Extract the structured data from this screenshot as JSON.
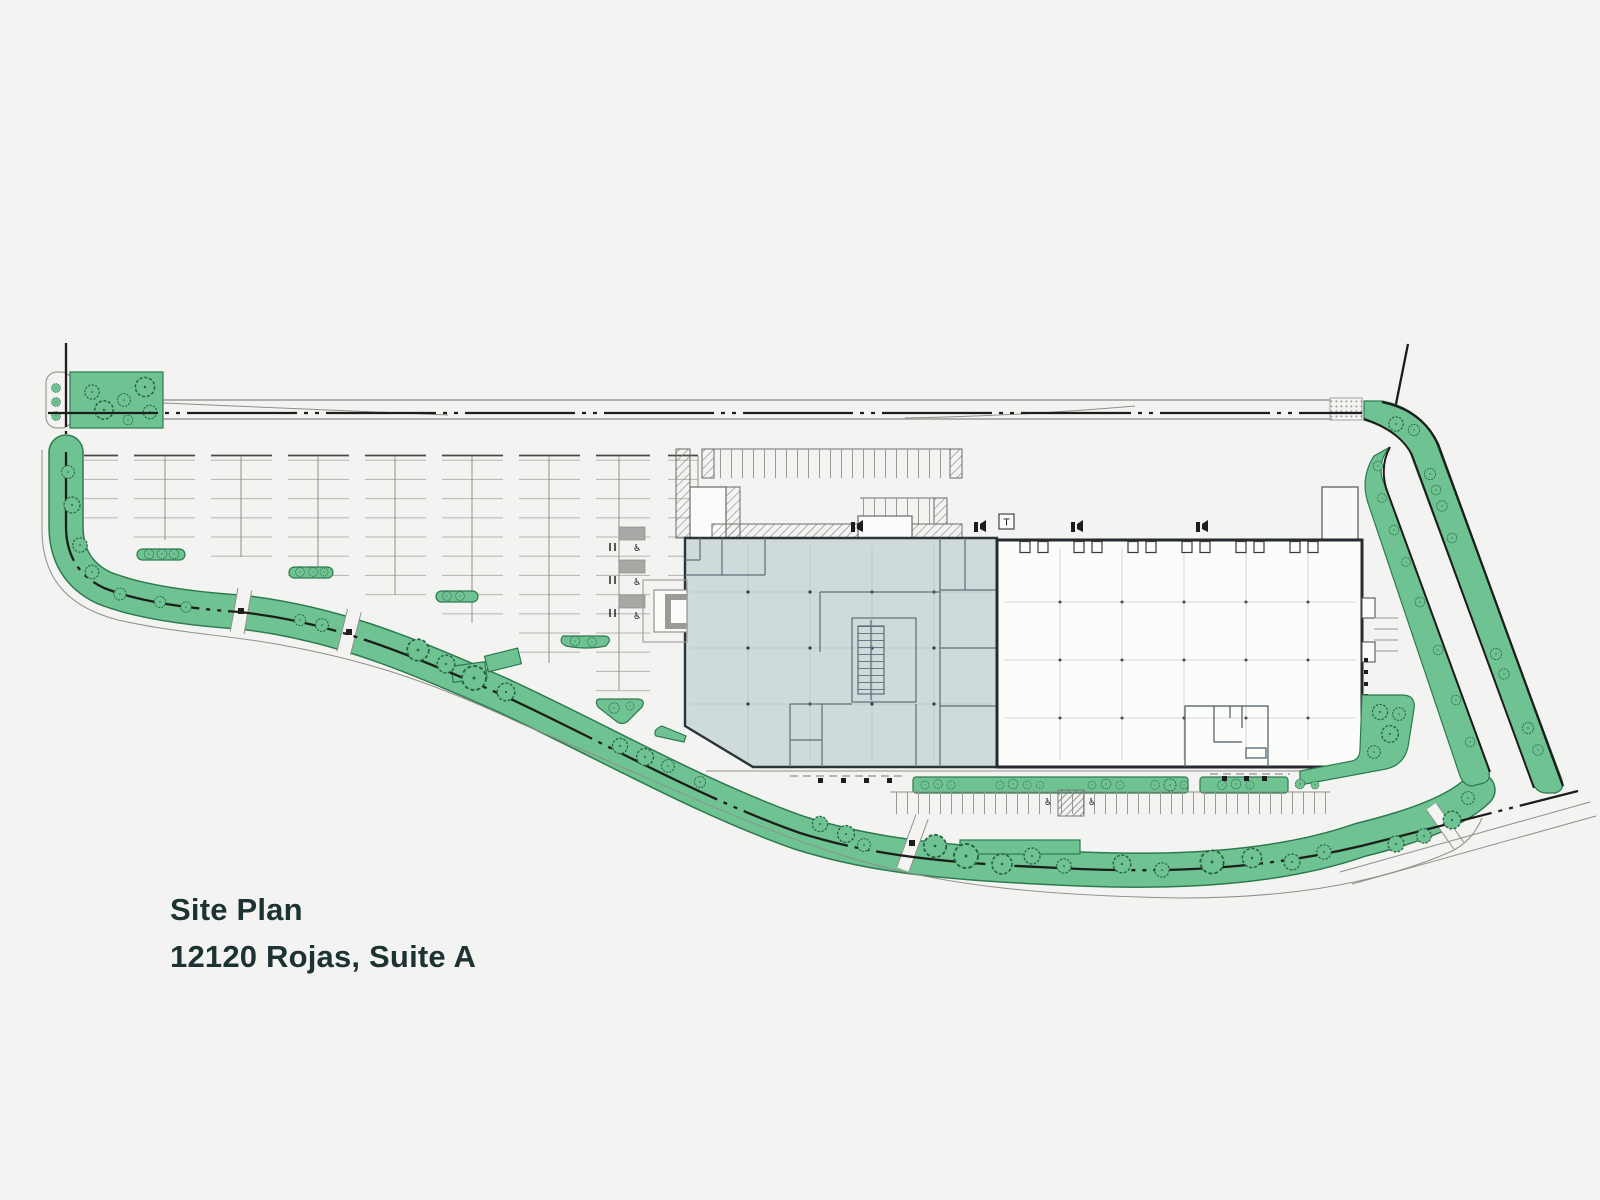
{
  "page": {
    "type": "site-plan-drawing",
    "background": "#f3f3f1"
  },
  "labels": {
    "title_line1": "Site Plan",
    "title_line2": "12120 Rojas, Suite A"
  },
  "annotations": {
    "transformer": "T",
    "accessible_symbol": "♿"
  },
  "colors": {
    "page_bg": "#f3f3f1",
    "landscape_green": "#6fc392",
    "landscape_outline": "#2e7a50",
    "suite_a_fill": "#cfdbdb",
    "building_outline": "#2b3438",
    "boundary_line": "#1d1d1b",
    "title_text": "#1d3233"
  }
}
